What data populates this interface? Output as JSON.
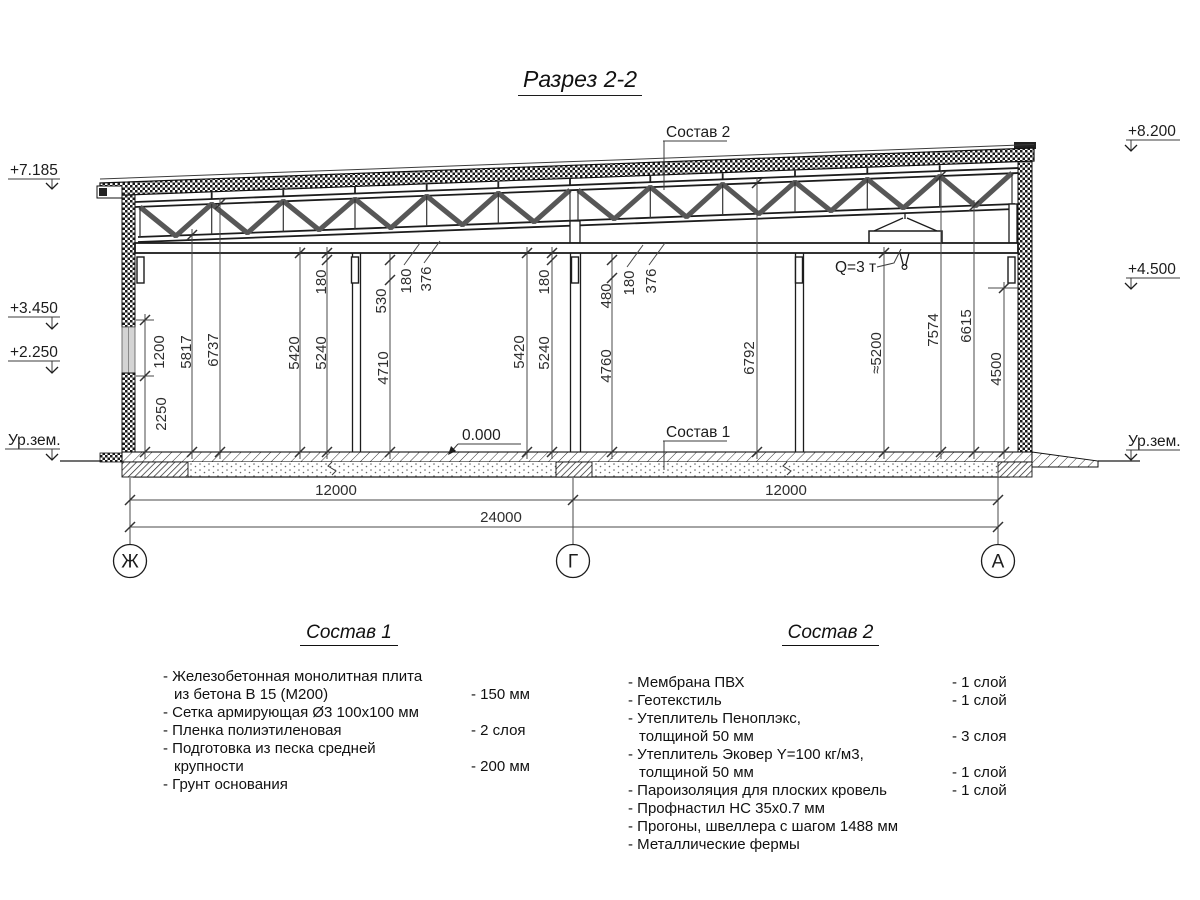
{
  "title": "Разрез 2-2",
  "drawing": {
    "callout_sostav2": "Состав 2",
    "callout_sostav1": "Состав 1",
    "zero_mark": "0.000",
    "crane_label": "Q=3 т",
    "elev_left": [
      "+7.185",
      "+3.450",
      "+2.250",
      "Ур.зем."
    ],
    "elev_right": [
      "+8.200",
      "+4.500",
      "Ур.зем."
    ],
    "axes": [
      "Ж",
      "Г",
      "А"
    ],
    "dims_h": [
      "12000",
      "12000",
      "24000"
    ],
    "dims_v": {
      "h1200": "1200",
      "h2250": "2250",
      "h5817": "5817",
      "h6737": "6737",
      "b1_5420": "5420",
      "b1_5240": "5240",
      "b1_180": "180",
      "c1_530": "530",
      "c1_180": "180",
      "c1_376": "376",
      "c1_4710": "4710",
      "b2_5420": "5420",
      "b2_5240": "5240",
      "b2_180": "180",
      "c2_480": "480",
      "c2_180": "180",
      "c2_376": "376",
      "c2_4760": "4760",
      "b2_6792": "6792",
      "r_5200": "≈5200",
      "r_7574": "7574",
      "r_6615": "6615",
      "r_4500": "4500"
    }
  },
  "sostav1": {
    "title": "Состав 1",
    "items": [
      {
        "name": "- Железобетонная  монолитная плита\nиз бетона В 15 (М200)",
        "value": "- 150 мм"
      },
      {
        "name": "- Сетка армирующая Ø3 100х100 мм",
        "value": ""
      },
      {
        "name": "- Пленка полиэтиленовая",
        "value": "-  2 слоя"
      },
      {
        "name": "- Подготовка из песка средней\nкрупности",
        "value": "- 200 мм"
      },
      {
        "name": "- Грунт основания",
        "value": ""
      }
    ]
  },
  "sostav2": {
    "title": "Состав 2",
    "items": [
      {
        "name": "- Мембрана ПВХ",
        "value": "- 1 слой"
      },
      {
        "name": "- Геотекстиль",
        "value": "- 1 слой"
      },
      {
        "name": "- Утеплитель Пеноплэкс,\nтолщиной 50 мм",
        "value": "- 3 слоя"
      },
      {
        "name": "- Утеплитель Эковер Y=100 кг/м3,\nтолщиной 50 мм",
        "value": "- 1 слой"
      },
      {
        "name": "- Пароизоляция для плоских кровель",
        "value": "- 1 слой"
      },
      {
        "name": "- Профнастил НС 35х0.7 мм",
        "value": ""
      },
      {
        "name": "- Прогоны, швеллера с шагом 1488 мм",
        "value": ""
      },
      {
        "name": "- Металлические фермы",
        "value": ""
      }
    ]
  }
}
